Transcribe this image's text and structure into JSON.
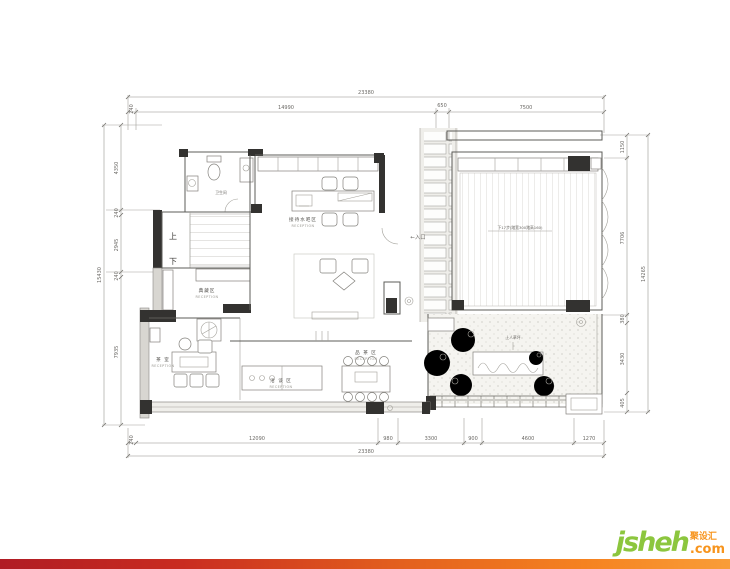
{
  "watermark": {
    "brand": "jsheh",
    "tld": ".com",
    "cn": "聚设汇"
  },
  "dims": {
    "top": {
      "overall": "23380",
      "pre": "240",
      "segments": [
        "14990",
        "650",
        "7500"
      ]
    },
    "bottom": {
      "overall": "23380",
      "pre": "240",
      "segments": [
        "12090",
        "980",
        "3300",
        "900",
        "4600",
        "1270"
      ]
    },
    "left": {
      "overall": "15430",
      "segments": [
        "4350",
        "240",
        "2945",
        "240",
        "7935"
      ]
    },
    "right": {
      "overall": "14265",
      "segments": [
        "1150",
        "7706",
        "380",
        "3430",
        "405"
      ]
    }
  },
  "labels": {
    "wc": "卫生间",
    "stair_up": "上",
    "stair_down": "下",
    "water_bar": "接待水吧区",
    "water_bar_en": "RECEPTION",
    "collection": "典藏区",
    "collection_en": "RECEPTION",
    "tea_room": "茶 室",
    "tea_room_en": "RECEPTION",
    "negotiation": "洽 谈 区",
    "negotiation_en": "RECEPTION",
    "tea_tasting": "品 茶 区",
    "tea_tasting_en": "RECEPTION",
    "entrance": "←入口",
    "deck_note": "下17步(踏宽300踏高160)",
    "lawn": "上人草坪"
  }
}
